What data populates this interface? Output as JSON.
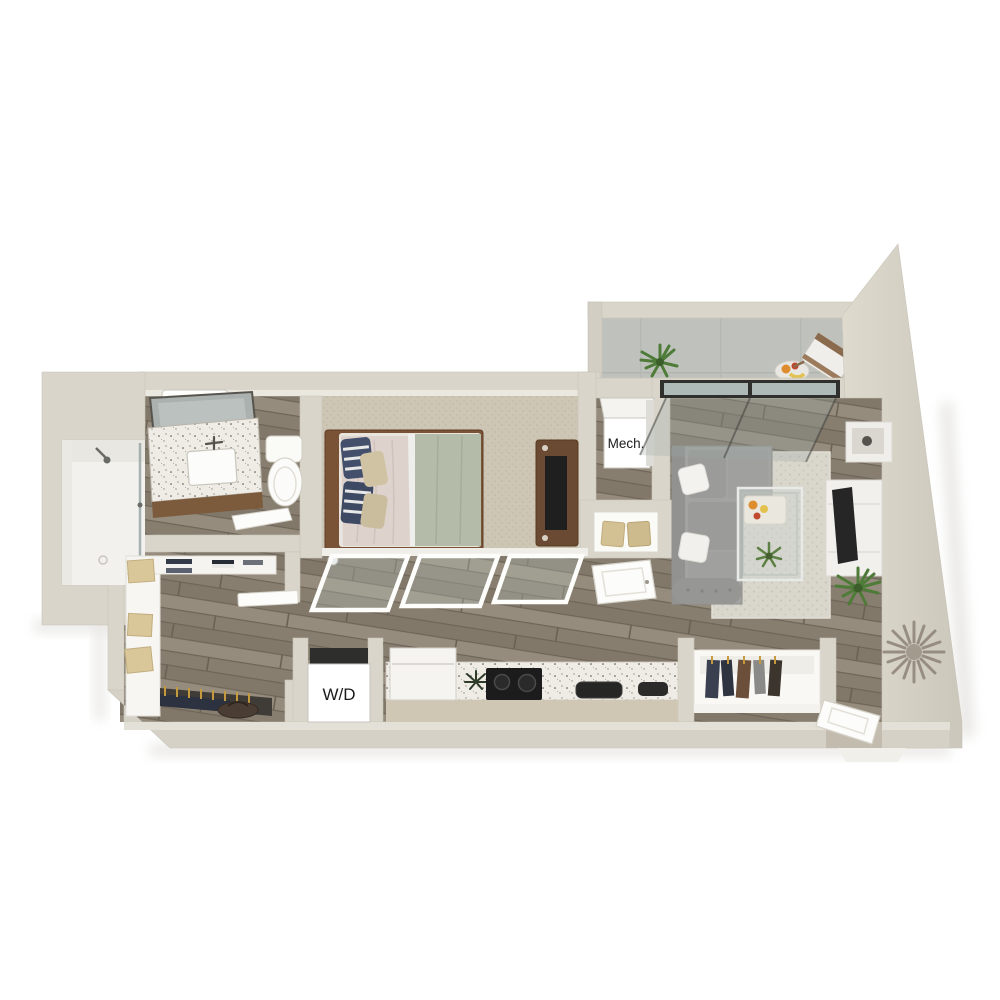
{
  "labels": {
    "mech_closet": "Mech.",
    "washer_dryer": "W/D"
  },
  "colors": {
    "background": "#ffffff",
    "wall": "#d9d5ca",
    "wall_face_light": "#ebe8e0",
    "wall_shadow": "#c9c4b8",
    "wood_floor": "#8b8273",
    "carpet": "#cdc6b5",
    "rug": "#d9d6cc",
    "balcony_concrete": "#bfc2bc",
    "counter_speckle": "#efece5",
    "sofa_gray": "#a3a3a1",
    "bed_duvet_green": "#b5bba9",
    "pillow_navy": "#44506b",
    "wood_furniture": "#6b4a33",
    "appliance_black": "#1c1c1c",
    "label_box": "#ffffff",
    "label_text": "#1b1b1b"
  }
}
